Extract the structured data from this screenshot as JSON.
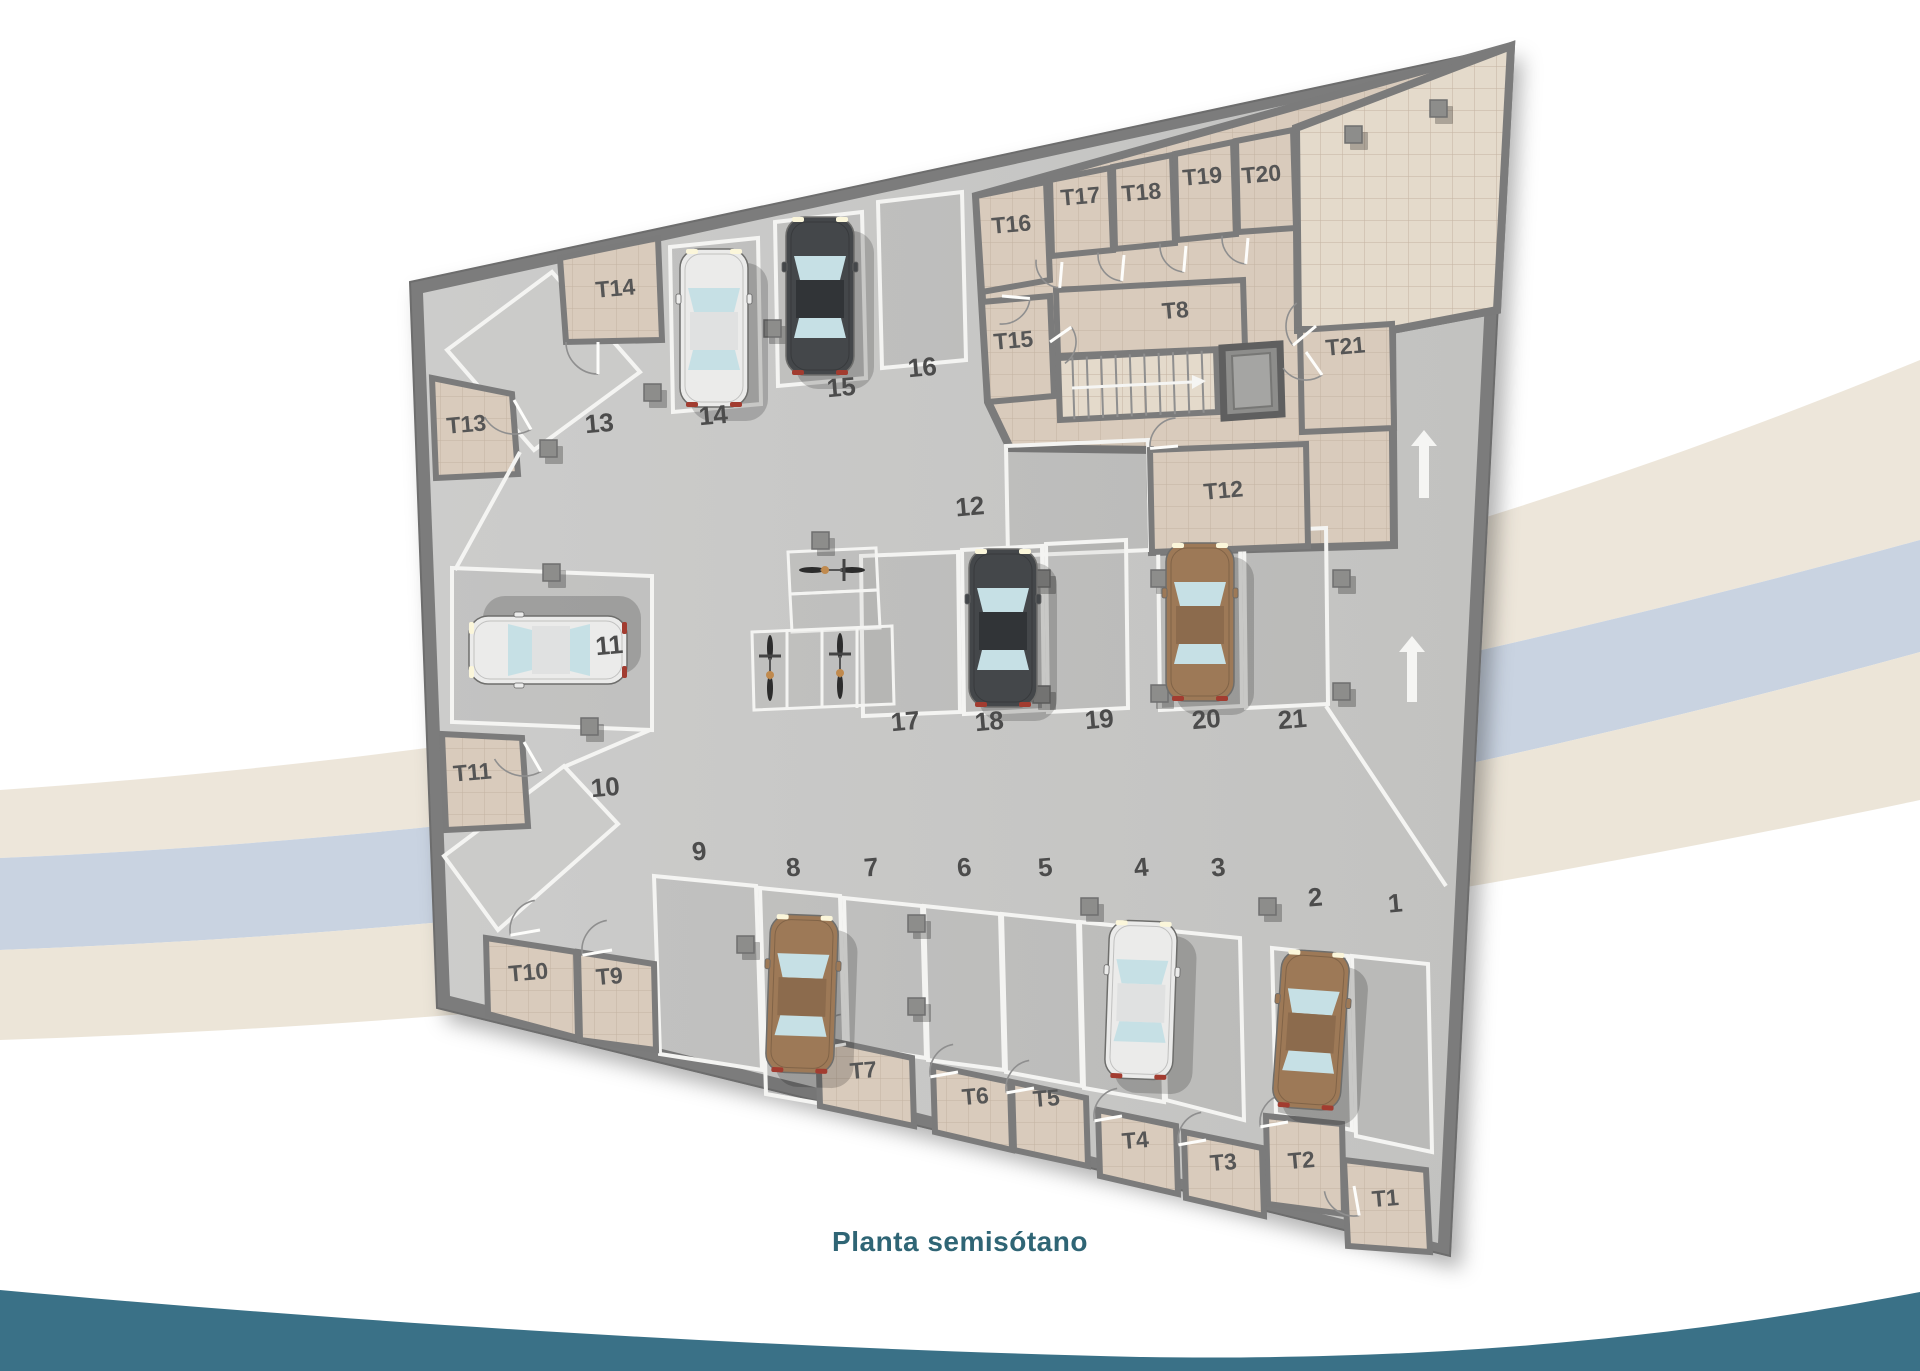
{
  "title": "Planta semisótano",
  "palette": {
    "background": "#ffffff",
    "wall": "#7b7b7b",
    "wall_dark": "#6d6d6d",
    "floor_a": "#cccccb",
    "floor_b": "#c2c2c0",
    "ramp": "#cbcbc9",
    "spot_shade": "rgba(0,0,0,0.045)",
    "tile": "#d9cbbc",
    "tile_light": "#e4dacb",
    "tile_grid": "#c4b3a2",
    "white_line": "#f4f4f2",
    "label": "#565656",
    "number": "#4c4c4c",
    "title_color": "#2f6575",
    "teal_band": "#3a7187",
    "blue_band": "#c9d3e1",
    "cream_band": "#eae2d4",
    "column": "#8d8d8b",
    "arrow": "#f5f5f3",
    "door": "#8f8f8f",
    "car_white": "#ebebea",
    "car_dark": "#44474a",
    "car_brown": "#9d7957",
    "glass": "#c6e0e5",
    "stair_tread": "#8f8f8f"
  },
  "storage_rooms": [
    "T1",
    "T2",
    "T3",
    "T4",
    "T5",
    "T6",
    "T7",
    "T8",
    "T9",
    "T10",
    "T11",
    "T12",
    "T13",
    "T14",
    "T15",
    "T16",
    "T17",
    "T18",
    "T19",
    "T20",
    "T21"
  ],
  "parking_spots": [
    "1",
    "2",
    "3",
    "4",
    "5",
    "6",
    "7",
    "8",
    "9",
    "10",
    "11",
    "12",
    "13",
    "14",
    "15",
    "16",
    "17",
    "18",
    "19",
    "20",
    "21"
  ],
  "cars": [
    {
      "spot": "2",
      "color": "brown"
    },
    {
      "spot": "4",
      "color": "white"
    },
    {
      "spot": "8",
      "color": "brown"
    },
    {
      "spot": "11",
      "color": "white"
    },
    {
      "spot": "14",
      "color": "white"
    },
    {
      "spot": "15",
      "color": "dark"
    },
    {
      "spot": "18",
      "color": "dark"
    },
    {
      "spot": "20",
      "color": "brown"
    }
  ],
  "bicycles": [
    {
      "area": "moto-top-cell"
    },
    {
      "area": "moto-rack-cell-1"
    },
    {
      "area": "moto-rack-cell-3"
    }
  ],
  "arrows": [
    {
      "direction": "up",
      "location": "right-driveway-upper"
    },
    {
      "direction": "up",
      "location": "right-driveway-lower"
    }
  ],
  "features": {
    "stairs": "stairs",
    "elevator": "elevator",
    "entry_ramps": [
      "13",
      "10"
    ]
  }
}
